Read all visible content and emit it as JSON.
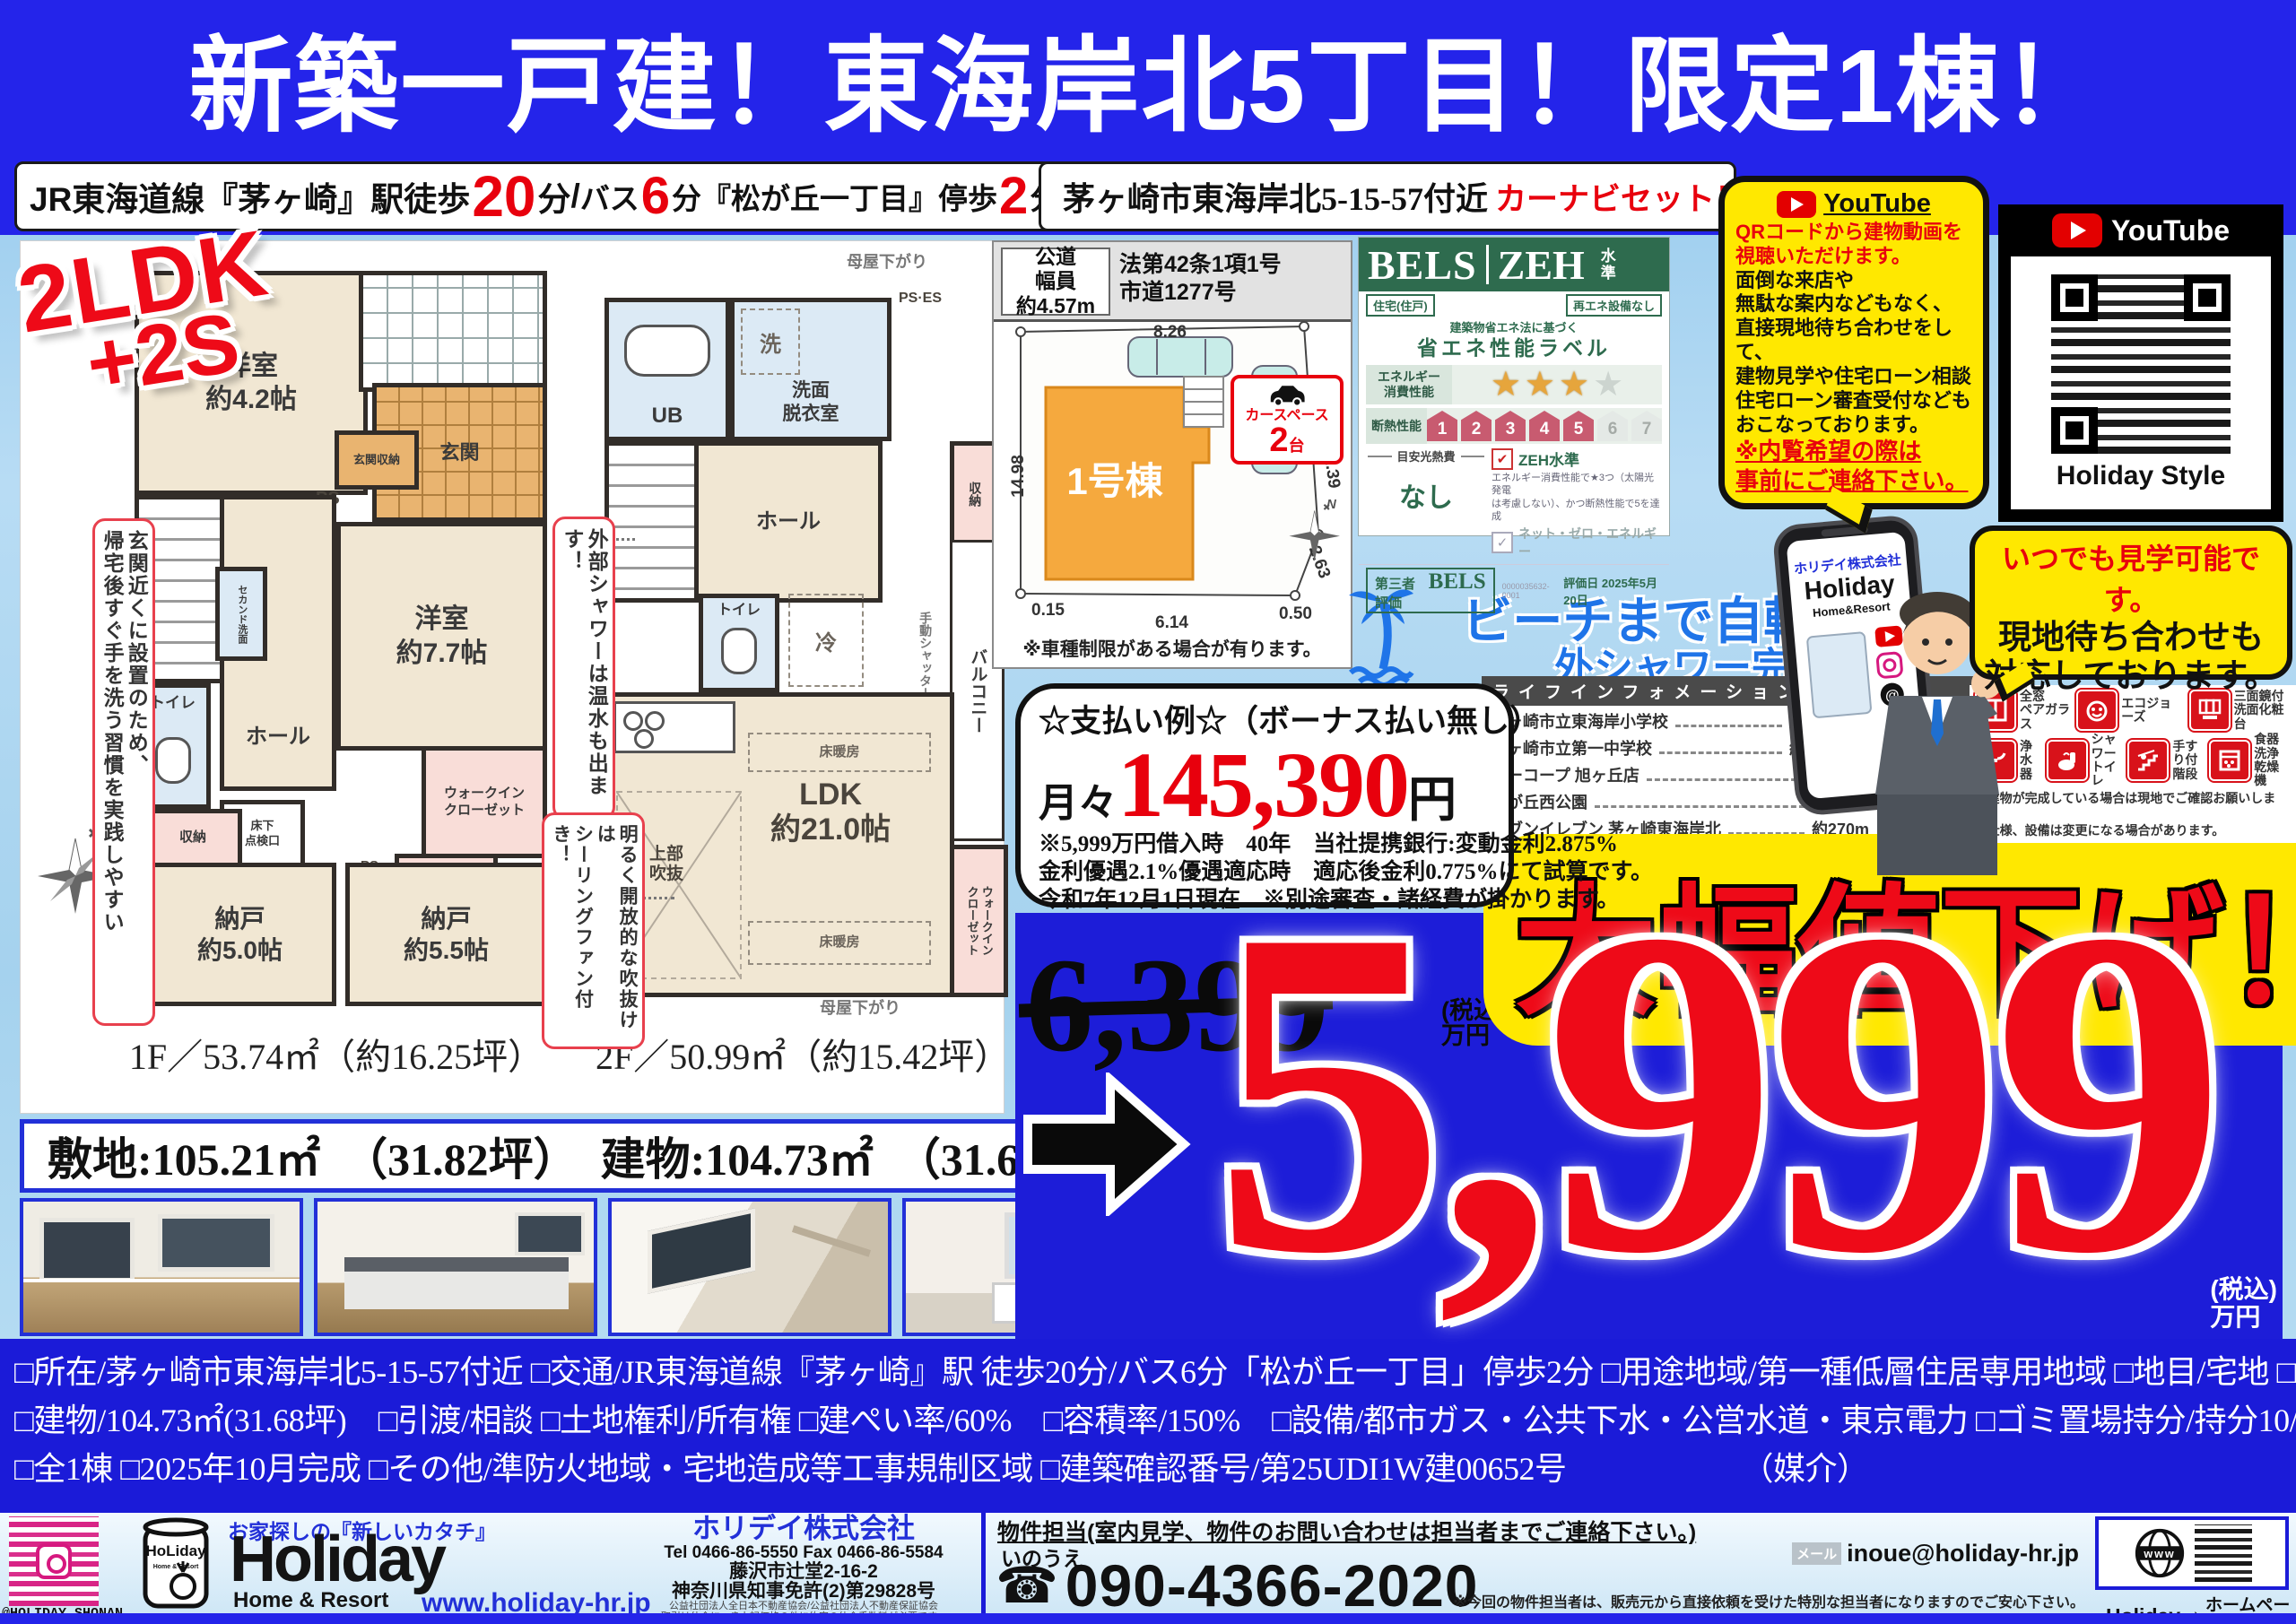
{
  "colors": {
    "banner_blue": "#2424ea",
    "price_blue": "#1d1dd8",
    "red": "#e8000d",
    "yellow": "#ffe800",
    "bels_green": "#2e6b4e",
    "link_blue": "#2230d8",
    "beach_blue": "#1f74e8",
    "insta_pink": "#d6187f"
  },
  "banner": {
    "title": "新築一戸建！東海岸北5丁目！限定1棟！"
  },
  "access": {
    "line_prefix": "JR東海道線『茅ヶ崎』駅徒歩",
    "walk_min": "20",
    "walk_unit": "分",
    "slash": "/",
    "bus_prefix": "バス",
    "bus_min": "6",
    "bus_mid": "分『松が丘一丁目』停歩",
    "stop_min": "2",
    "stop_unit": "分",
    "address": "茅ヶ崎市東海岸北5-15-57付近",
    "carnavi": "カーナビセット！"
  },
  "plan_badge": {
    "line1": "2LDK",
    "line2": "+2S"
  },
  "floor1": {
    "caption": "1F／53.74㎡（約16.25坪）",
    "yoshitsu42": "洋室\n約4.2帖",
    "genkan": "玄関",
    "genkan_shuno": "玄関収納",
    "ps": "PS",
    "up": "UP",
    "hall": "ホール",
    "second_senmen": "セカンド洗面",
    "toilet": "トイレ",
    "yukashita": "床下\n点検口",
    "shuno": "収納",
    "wic": "ウォークイン\nクローゼット",
    "yoshitsu77": "洋室\n約7.7帖",
    "nando50": "納戸\n約5.0帖",
    "nando55": "納戸\n約5.5帖"
  },
  "floor2": {
    "caption": "2F／50.99㎡（約15.42坪）",
    "ub": "UB",
    "sen": "洗",
    "senmen": "洗面\n脱衣室",
    "pses": "PS·ES",
    "dn": "DN",
    "hall": "ホール",
    "shuno": "収納",
    "toilet": "トイレ",
    "rei": "冷",
    "ldk": "LDK\n約21.0帖",
    "yukadanbo": "床暖房",
    "fukinuke": "上部\n吹抜",
    "balcony": "バルコニー",
    "shutter": "手動シャッター",
    "wic": "ウォークイン\nクローゼット",
    "moya": "母屋下がり"
  },
  "plan_notes": {
    "entrance": "玄関近くに設置のため、\n帰宅後すぐ手を洗う習慣を実践しやすい",
    "shower": "外部シャワーは温水も出ます！",
    "fan": "明るく開放的な吹抜けは\nシーリングファン付き！"
  },
  "area_band": {
    "text": "敷地:105.21㎡　（31.82坪）　建物:104.73㎡　（31.68坪）"
  },
  "siteplan": {
    "road_width": "公道\n幅員\n約4.57m",
    "road_law": "法第42条1項1号\n市道1277号",
    "building": "1号棟",
    "dims": {
      "top": "8.26",
      "left": "14.98",
      "right": "12.39",
      "right2": "2.63",
      "bl": "0.15",
      "bottom": "6.14",
      "br": "0.50"
    },
    "carspace": {
      "label": "カースペース",
      "count": "2",
      "unit": "台"
    },
    "note": "※車種制限がある場合が有ります。"
  },
  "bels": {
    "brand": "BELS",
    "zeh": "ZEH",
    "zeh_sub": "水準",
    "tag_left": "住宅(住戸)",
    "tag_right": "再エネ設備なし",
    "law": "建築物省エネ法に基づく",
    "label": "省エネ性能ラベル",
    "row1": "エネルギー\n消費性能",
    "row2": "断熱性能",
    "star": "★",
    "houses": [
      "1",
      "2",
      "3",
      "4",
      "5",
      "6",
      "7"
    ],
    "meyasu": "目安光熱費",
    "nashi": "なし",
    "check": "✔",
    "check_gray": "✓",
    "zeh_level": "ZEH水準",
    "zeh_note": "エネルギー消費性能で★3つ（太陽光発電\nは考慮しない）、かつ断熱性能で5を達成",
    "netzero": "ネット・ゼロ・エネルギー",
    "third": "第三者評価",
    "third_brand": "BELS",
    "cert_id": "0000035632-0001",
    "date": "評価日 2025年5月20日"
  },
  "beach": {
    "line1": "ビーチまで自転車5分",
    "line2": "外シャワー完備♪"
  },
  "lifeinfo": {
    "header": "ライフインフォメーション",
    "items": [
      {
        "name": "茅ヶ崎市立東海岸小学校",
        "dist": "約1,100m（徒歩約14分）"
      },
      {
        "name": "茅ヶ崎市立第一中学校",
        "dist": "約1,000m（徒歩約13分）"
      },
      {
        "name": "ユーコープ 旭ヶ丘店",
        "dist": "約500m（徒歩約7分）"
      },
      {
        "name": "松が丘西公園",
        "dist": "約350m（徒歩約5分）"
      },
      {
        "name": "セブンイレブン 茅ヶ崎東海岸北",
        "dist": "約270m（徒歩約4分）"
      }
    ]
  },
  "payment": {
    "title": "☆支払い例☆（ボーナス払い無し）",
    "monthly": "月々",
    "amount": "145,390",
    "unit": "円",
    "note1": "※5,999万円借入時　40年　当社提携銀行:変動金利2.875%",
    "note2": "金利優遇2.1%優遇適応時　適応後金利0.775%にて試算です。",
    "note3": "令和7年12月1日現在　※別途審査・諸経費が掛かります。"
  },
  "price": {
    "old": "6,399",
    "old_tax": "(税込)\n万円",
    "badge": "大幅値下げ！",
    "new": "5,999",
    "new_tax": "(税込)\n万円"
  },
  "youtube": {
    "brand": "YouTube",
    "lines_red": [
      "QRコードから建物動画を",
      "視聴いただけます。"
    ],
    "lines": [
      "面倒な来店や",
      "無駄な案内などもなく、",
      "直接現地待ち合わせをして、",
      "建物見学や住宅ローン相談",
      "住宅ローン審査受付なども",
      "おこなっております。"
    ],
    "lines_red2": [
      "※内覧希望の際は",
      "事前にご連絡下さい。"
    ]
  },
  "qrbox": {
    "brand": "YouTube",
    "caption": "Holiday Style"
  },
  "phone_screen": {
    "company": "ホリデイ株式会社",
    "logo": "Holiday",
    "sub": "Home&Resort"
  },
  "visit": {
    "line1": "いつでも見学可能です。",
    "line2": "現地待ち合わせも",
    "line3": "対応しております。"
  },
  "features": {
    "items": [
      "全窓\nペアガラス",
      "エコジョーズ",
      "三面鏡付\n洗面化粧台",
      "浄水器",
      "シャワー\nトイレ",
      "手すり付\n階段",
      "食器洗浄\n乾燥機"
    ],
    "note1": "※建物が完成している場合は現地でご確認お願いします。",
    "note2": "※仕様、設備は変更になる場合があります。"
  },
  "details": {
    "line1": "□所在/茅ヶ崎市東海岸北5-15-57付近 □交通/JR東海道線『茅ヶ崎』駅 徒歩20分/バス6分「松が丘一丁目」停歩2分 □用途地域/第一種低層住居専用地域 □地目/宅地 □土地/105.21㎡(31.82坪)",
    "line2": "□建物/104.73㎡(31.68坪)　□引渡/相談 □土地権利/所有権 □建ぺい率/60%　□容積率/150%　□設備/都市ガス・公共下水・公営水道・東京電力 □ゴミ置場持分/持分10/120 □構造/木造2階建",
    "line3": "□全1棟 □2025年10月完成 □その他/準防火地域・宅地造成等工事規制区域 □建築確認番号/第25UDI1W建00652号　　　　　　（媒介）"
  },
  "footer": {
    "insta_handle": "@HOLIDAY_SHONAN_",
    "tagline": "お家探しの『新しいカタチ』",
    "logo": "Holiday",
    "logo_sub": "Home & Resort",
    "url": "www.holiday-hr.jp",
    "can_text": "HoLiday",
    "can_sub": "Home & Resort",
    "company": "ホリデイ株式会社",
    "telfax": "Tel 0466-86-5550  Fax 0466-86-5584",
    "address": "藤沢市辻堂2-16-2",
    "license": "神奈川県知事免許(2)第29828号",
    "assoc": "公益社団法人全日本不動産協会/公益社団法人不動産保証協会",
    "assoc2": "取引は仲介につき上記価格の他に約定の仲介手数料が必要です。",
    "contact_header": "物件担当(室内見学、物件のお問い合わせは担当者までご連絡下さい。)",
    "person": "いのうえ",
    "mail_label": "メール",
    "mail": "inoue@holiday-hr.jp",
    "phone": "090-4366-2020",
    "phone_icon": "☎",
    "note": "※今回の物件担当者は、販売元から直接依頼を受けた特別な担当者になりますのでご安心下さい。",
    "hp_brand": "Holiday",
    "hp_label": "ホームページ",
    "www": "www"
  }
}
